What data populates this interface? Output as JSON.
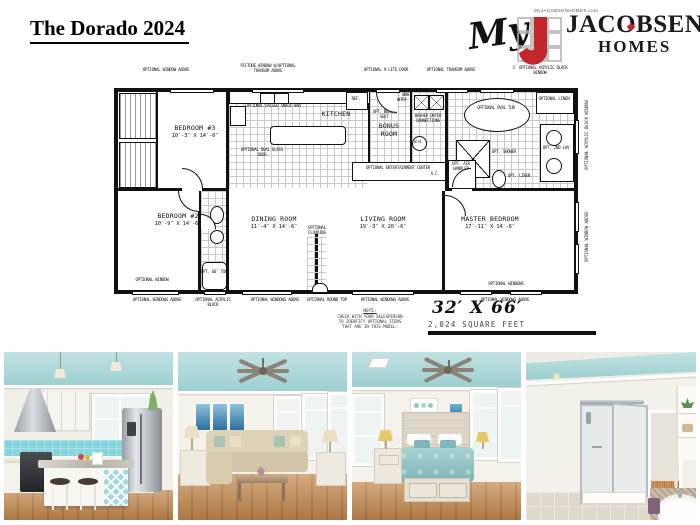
{
  "page_title": "The Dorado 2024",
  "brand": {
    "tagline": "MyJACOBSENHOMES.com",
    "script_word": "My",
    "name_top": "JACOBSEN",
    "name_bottom": "HOMES",
    "brand_red": "#c1272d"
  },
  "plan": {
    "dimensions": "32′ X 66′",
    "square_feet": "2,024 SQUARE FEET",
    "note": {
      "line1": "NOTE:",
      "line2": "CHECK WITH YOUR SALESPERSON",
      "line3": "TO IDENTIFY OPTIONAL ITEMS",
      "line4": "THAT ARE IN THIS MODEL."
    },
    "rooms": {
      "bedroom3": {
        "name": "BEDROOM #3",
        "dims": "10′-3″ X 14′-6″"
      },
      "kitchen": {
        "name": "KITCHEN"
      },
      "bonus": {
        "name": "BONUS ROOM"
      },
      "bedroom2": {
        "name": "BEDROOM #2",
        "dims": "10′-9″ X 14′-6″"
      },
      "dining": {
        "name": "DINING ROOM",
        "dims": "11′-4″ X 14′-6″"
      },
      "living": {
        "name": "LIVING ROOM",
        "dims": "19′-3″ X 20′-6″"
      },
      "master": {
        "name": "MASTER BEDROOM",
        "dims": "17′-11″ X 14′-6″"
      }
    },
    "labels": {
      "top1": "OPTIONAL WINDOW ABOVE",
      "top2": "PICTURE WINDOW W/OPTIONAL TRANSOM ABOVE",
      "top3": "OPTIONAL 9-LITE DOOR",
      "top4": "OPTIONAL TRANSOM ABOVE",
      "top5": "3′ OPTIONAL ACRYLIC BLOCK WINDOW",
      "bottom_windows": "OPTIONAL WINDOWS ABOVE",
      "bottom_acrylic": "OPTIONAL ACRYLIC BLOCK",
      "bottom_roundtop": "OPTIONAL ROUND TOP",
      "optional_window": "OPTIONAL WINDOW",
      "optional_windows": "OPTIONAL WINDOWS",
      "right_acrylic": "OPTIONAL ACRYLIC BLOCK WINDOW",
      "oval_tub": "OPTIONAL OVAL TUB",
      "linen": "OPTIONAL LINEN",
      "opt_linen": "OPT. LINEN",
      "shower": "OPT. SHOWER",
      "dbl_lav": "OPT. 2ND LAV",
      "ent": "OPTIONAL ENTERTAINMENT CENTER",
      "washer": "WASHER DRYER CONNECTIONS",
      "wh": "W.H.",
      "ref": "REF.",
      "air": "OPT. AIR HANDLER",
      "ac": "A.C.",
      "tub60": "OPT. 60″ TUB",
      "flooring": "OPTIONAL FLOORING",
      "pantry": "OPT. WDW PANTRY",
      "bench": "OPT. BENCH SEAT",
      "snack": "OPTIONAL RAISED SNACK BAR",
      "glass_door": "OPTIONAL DUAL GLASS DOOR"
    }
  },
  "photos": [
    {
      "name": "kitchen"
    },
    {
      "name": "living-room"
    },
    {
      "name": "master-bedroom"
    },
    {
      "name": "master-bathroom"
    }
  ],
  "accent_colors": {
    "teal_ceiling": "#9ccfd1",
    "teal_backsplash": "#86d4dc",
    "wood_floor": "#c78f57",
    "brand_red": "#c1272d"
  }
}
